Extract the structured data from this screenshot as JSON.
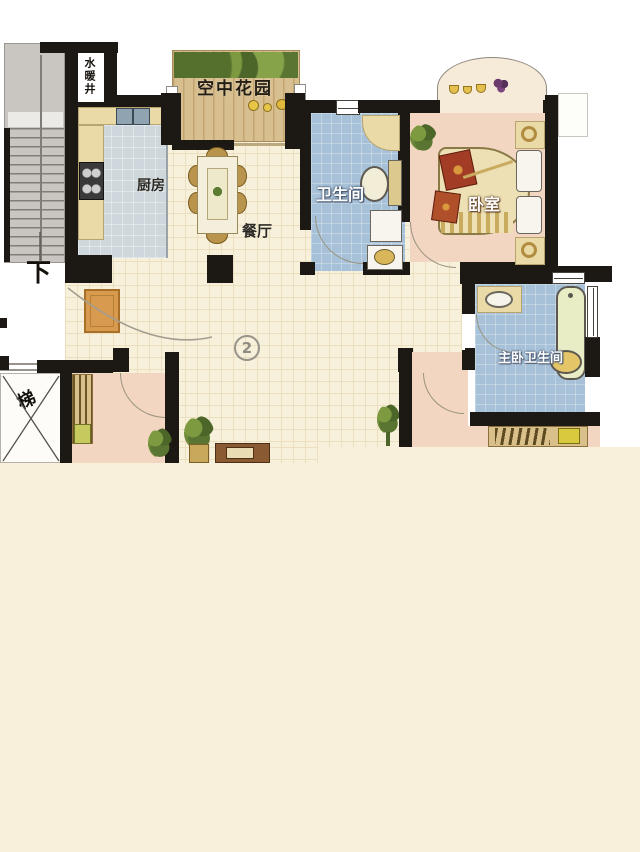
{
  "title": "apartment-floor-plan",
  "rooms": {
    "water_shaft": {
      "label": "水暖井"
    },
    "sky_garden": {
      "label": "空中花园"
    },
    "kitchen": {
      "label": "厨房"
    },
    "dining_room": {
      "label": "餐厅"
    },
    "bathroom": {
      "label": "卫生间"
    },
    "bedroom": {
      "label": "卧室"
    },
    "master_bathroom": {
      "label": "主卧卫生间"
    }
  },
  "annotations": {
    "stairs_down_label": "下",
    "elevator_label": "梯",
    "unit_number": "2"
  },
  "colors": {
    "wall": "#1c1813",
    "background_cream": "#f8f0da",
    "hall_floor": "#f7f0da",
    "bedroom_pink": "#f3d6c2",
    "bath_blue": "#a7c2d8",
    "kitchen_floor": "#ced7db",
    "garden_deck": "#d7bf90",
    "counter_tan": "#eadaa8",
    "stairs_gray": "#c9c6c2",
    "chair_gold": "#b9944d",
    "doormat_orange": "#d89a4e",
    "blanket_red": "#9e3b24",
    "bathtub_green": "#e9edc6"
  }
}
